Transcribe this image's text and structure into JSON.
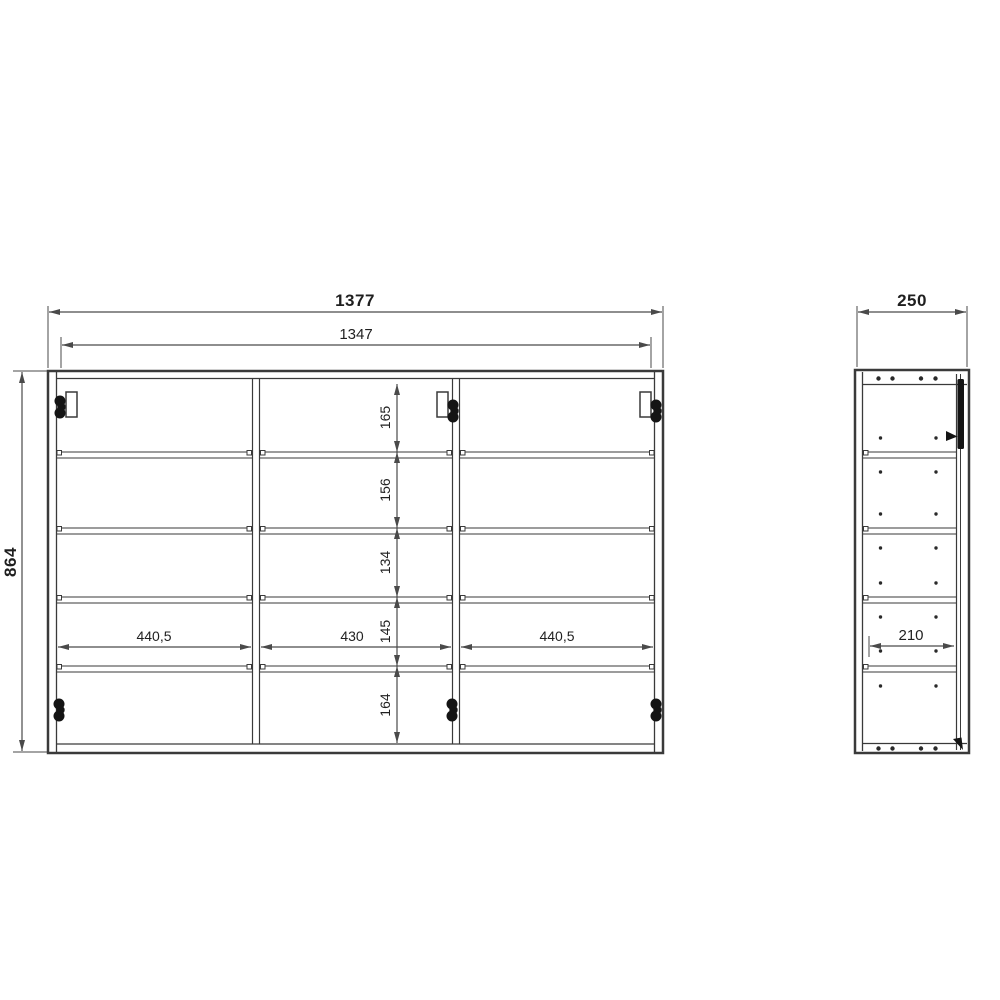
{
  "drawing": {
    "front_view": {
      "overall_width": "1377",
      "inner_width": "1347",
      "overall_height": "864",
      "row_heights": [
        "165",
        "156",
        "134",
        "145",
        "164"
      ],
      "column_widths": [
        "440,5",
        "430",
        "440,5"
      ]
    },
    "side_view": {
      "overall_depth": "250",
      "inner_depth": "210"
    },
    "colors": {
      "line": "#3a3a3a",
      "dimension_line": "#4a4a4a",
      "text": "#1f1f1f",
      "hardware": "#141414",
      "background": "#ffffff"
    }
  }
}
